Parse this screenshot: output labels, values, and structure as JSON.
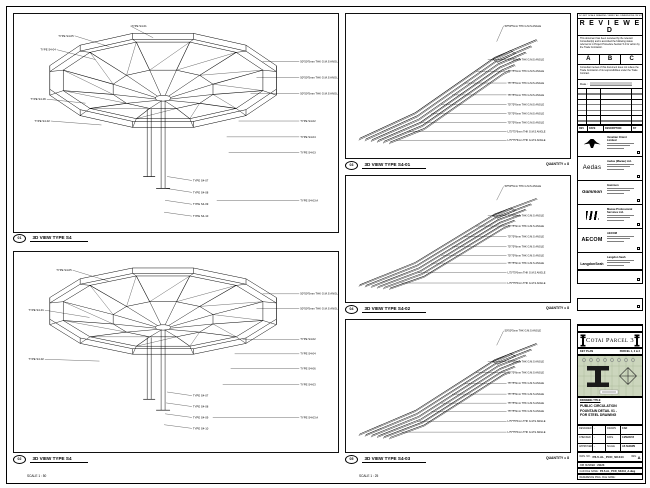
{
  "stamp": {
    "note": "DO NOT SCALE DRAWING. VERIFY ALL DIMENSIONS ON SITE.",
    "title": "R E V I E W E D",
    "body1": "This document has been reviewed by the relevant Consultant(s) and is accorded the following status referred to in Project Procedure Section 5.4 for action by the Trade Contractor.",
    "options": [
      "A",
      "B",
      "C"
    ],
    "body2": "Consultant review of this document does not relieve the Trade Contractor of its responsibilities under the Trade Contract.",
    "date_label": "Date :"
  },
  "revision": {
    "headers": [
      "REV",
      "DATE",
      "DESCRIPTION",
      "BY"
    ]
  },
  "companies": [
    {
      "logo_class": "logo-venetian",
      "logo_name": "venetian-logo-icon",
      "logo_text": "",
      "name": "Venetian Orient Limited"
    },
    {
      "logo_class": "logo-aedas",
      "logo_name": "aedas-logo",
      "logo_text": "Aedas",
      "name": "Aedas (Macau) Ltd."
    },
    {
      "logo_class": "logo-gammon",
      "logo_name": "gammon-logo",
      "logo_text": "Gammon",
      "name": "Gammon"
    },
    {
      "logo_class": "logo-mps",
      "logo_name": "mps-logo-icon",
      "logo_text": "",
      "name": "Macau Professional Services Ltd."
    },
    {
      "logo_class": "logo-aecom",
      "logo_name": "aecom-logo",
      "logo_text": "AECOM",
      "name": "AECOM"
    },
    {
      "logo_class": "logo-langdon",
      "logo_name": "langdon-seah-logo",
      "logo_text": "LangdonSeah",
      "name": "Langdon Seah"
    }
  ],
  "contractor": {
    "name": "Hsin Chong Construction (Macau) Co. Ltd."
  },
  "project": {
    "label": "PROJECT TITLE",
    "title": "Cotai Parcel 3"
  },
  "keyplan": {
    "label": "KEY PLAN",
    "parcel": "PARCEL 1, 2 & 3"
  },
  "titleblock": {
    "label": "DRAWING TITLE",
    "title_lines": [
      "PUBLIC CIRCULATION",
      "FOUNTAIN DETAIL 01 -",
      "FOR STEEL DRAWING"
    ],
    "info": [
      [
        "DESIGNED",
        "-",
        "DRAWN",
        "CAD"
      ],
      [
        "CHECKED",
        "-",
        "DATE",
        "14/MAR/15"
      ],
      [
        "APPROVED",
        "-",
        "SCALE",
        "AS SHOWN"
      ]
    ],
    "dwg_label": "DWG. NO.",
    "dwg_no": "P3-5-AL_PCD_SK444",
    "rev_label": "REV.",
    "rev": "A",
    "job_label": "JOB NUMBER :",
    "job_no": "21123",
    "cad_label": "CAD FILE NAME :",
    "cad_file": "P3-5-AL_PCD_SK444_A.dwg",
    "ref_label": "REFERENCE DWG. FILE NAME :"
  },
  "views": {
    "left_top": {
      "num": "01",
      "title": "3D VIEW TYPE S4",
      "scale": "SCALE 1 : 50",
      "annotations": [
        {
          "t": "TYPE S4-01",
          "lx": 118,
          "ly": 12,
          "tx": 140,
          "ty": 24,
          "anchor": "start"
        },
        {
          "t": "TYPE S4-05",
          "lx": 60,
          "ly": 22,
          "tx": 96,
          "ty": 33,
          "anchor": "end"
        },
        {
          "t": "TYPE S4-04",
          "lx": 42,
          "ly": 36,
          "tx": 82,
          "ty": 46,
          "anchor": "end"
        },
        {
          "t": "TYPE S4-06",
          "lx": 32,
          "ly": 86,
          "tx": 72,
          "ty": 90,
          "anchor": "end"
        },
        {
          "t": "TYPE S4-02",
          "lx": 36,
          "ly": 108,
          "tx": 88,
          "ty": 112,
          "anchor": "end"
        },
        {
          "t": "50*50*5mm THK G.M.S ANGLE",
          "lx": 288,
          "ly": 48,
          "tx": 250,
          "ty": 48,
          "anchor": "start"
        },
        {
          "t": "50*50*5mm THK G.M.S ANGLE",
          "lx": 288,
          "ly": 64,
          "tx": 244,
          "ty": 64,
          "anchor": "start"
        },
        {
          "t": "50*50*5mm THK G.M.S ANGLE",
          "lx": 288,
          "ly": 80,
          "tx": 238,
          "ty": 80,
          "anchor": "start"
        },
        {
          "t": "TYPE S4-02",
          "lx": 288,
          "ly": 108,
          "tx": 226,
          "ty": 108,
          "anchor": "start"
        },
        {
          "t": "TYPE S4-04",
          "lx": 288,
          "ly": 124,
          "tx": 214,
          "ty": 124,
          "anchor": "start"
        },
        {
          "t": "TYPE S4-03",
          "lx": 288,
          "ly": 140,
          "tx": 216,
          "ty": 140,
          "anchor": "start"
        },
        {
          "t": "TYPE S4-03 A",
          "lx": 288,
          "ly": 188,
          "tx": 204,
          "ty": 188,
          "anchor": "start"
        },
        {
          "t": "TYPE S4-07",
          "lx": 180,
          "ly": 168,
          "tx": 154,
          "ty": 164,
          "anchor": "start"
        },
        {
          "t": "TYPE S4-08",
          "lx": 180,
          "ly": 180,
          "tx": 153,
          "ty": 176,
          "anchor": "start"
        },
        {
          "t": "TYPE S4-09",
          "lx": 180,
          "ly": 192,
          "tx": 152,
          "ty": 188,
          "anchor": "start"
        },
        {
          "t": "TYPE S4-10",
          "lx": 180,
          "ly": 204,
          "tx": 151,
          "ty": 200,
          "anchor": "start"
        }
      ]
    },
    "left_bottom": {
      "num": "02",
      "title": "3D VIEW TYPE S4",
      "scale": "SCALE 1 : 50",
      "annotations": [
        {
          "t": "TYPE S4-05",
          "lx": 58,
          "ly": 20,
          "tx": 95,
          "ty": 32,
          "anchor": "end"
        },
        {
          "t": "TYPE S4-01",
          "lx": 30,
          "ly": 64,
          "tx": 76,
          "ty": 72,
          "anchor": "end"
        },
        {
          "t": "TYPE S4-02",
          "lx": 30,
          "ly": 118,
          "tx": 86,
          "ty": 120,
          "anchor": "end"
        },
        {
          "t": "50*50*5mm THK G.M.S ANGLE",
          "lx": 288,
          "ly": 46,
          "tx": 250,
          "ty": 46,
          "anchor": "start"
        },
        {
          "t": "50*50*5mm THK G.M.S ANGLE",
          "lx": 288,
          "ly": 62,
          "tx": 244,
          "ty": 62,
          "anchor": "start"
        },
        {
          "t": "TYPE S4-02",
          "lx": 288,
          "ly": 96,
          "tx": 230,
          "ty": 96,
          "anchor": "start"
        },
        {
          "t": "TYPE S4-04",
          "lx": 288,
          "ly": 112,
          "tx": 222,
          "ty": 112,
          "anchor": "start"
        },
        {
          "t": "TYPE S4-06",
          "lx": 288,
          "ly": 128,
          "tx": 218,
          "ty": 128,
          "anchor": "start"
        },
        {
          "t": "TYPE S4-03",
          "lx": 288,
          "ly": 146,
          "tx": 210,
          "ty": 146,
          "anchor": "start"
        },
        {
          "t": "TYPE S4-03 A",
          "lx": 288,
          "ly": 182,
          "tx": 200,
          "ty": 182,
          "anchor": "start"
        },
        {
          "t": "TYPE S4-07",
          "lx": 180,
          "ly": 158,
          "tx": 154,
          "ty": 154,
          "anchor": "start"
        },
        {
          "t": "TYPE S4-08",
          "lx": 180,
          "ly": 170,
          "tx": 153,
          "ty": 166,
          "anchor": "start"
        },
        {
          "t": "TYPE S4-09",
          "lx": 180,
          "ly": 182,
          "tx": 152,
          "ty": 178,
          "anchor": "start"
        },
        {
          "t": "TYPE S4-10",
          "lx": 180,
          "ly": 194,
          "tx": 151,
          "ty": 190,
          "anchor": "start"
        }
      ]
    },
    "mid_top": {
      "num": "03",
      "title": "3D VIEW TYPE S4-01",
      "scale": "SCALE 1 : 25",
      "quantity": "QUANTITY = 8",
      "annotations": [
        {
          "t": "50*50*5mm THK G.M.S ANGLE",
          "lx": 160,
          "ly": 12,
          "tx": 152,
          "ty": 28,
          "anchor": "start"
        },
        {
          "t": "75*75*6mm THK G.M.S ANGLE",
          "lx": 163,
          "ly": 46,
          "tx": 143,
          "ty": 46,
          "anchor": "start"
        },
        {
          "t": "75*75*6mm THK G.M.S ANGLE",
          "lx": 163,
          "ly": 58,
          "tx": 131,
          "ty": 58,
          "anchor": "start"
        },
        {
          "t": "75*75*6mm THK G.M.S ANGLE",
          "lx": 163,
          "ly": 70,
          "tx": 119,
          "ty": 70,
          "anchor": "start"
        },
        {
          "t": "75*75*6mm THK G.M.S ANGLE",
          "lx": 163,
          "ly": 82,
          "tx": 107,
          "ty": 82,
          "anchor": "start"
        },
        {
          "t": "75*75*6mm THK G.M.S ANGLE",
          "lx": 163,
          "ly": 92,
          "tx": 96,
          "ty": 92,
          "anchor": "start"
        },
        {
          "t": "75*75*6mm THK G.M.S ANGLE",
          "lx": 163,
          "ly": 101,
          "tx": 86,
          "ty": 101,
          "anchor": "start"
        },
        {
          "t": "75*75*6mm THK G.M.S ANGLE",
          "lx": 163,
          "ly": 110,
          "tx": 75,
          "ty": 110,
          "anchor": "start"
        },
        {
          "t": "L75*75*6mm THK G.M.S ANGLE",
          "lx": 163,
          "ly": 119,
          "tx": 63,
          "ty": 119,
          "anchor": "start"
        },
        {
          "t": "L75*75*6mm THK G.M.S ANGLE",
          "lx": 163,
          "ly": 128,
          "tx": 51,
          "ty": 128,
          "anchor": "start"
        }
      ]
    },
    "mid_mid": {
      "num": "04",
      "title": "3D VIEW TYPE S4-02",
      "scale": "SCALE 1 : 25",
      "quantity": "QUANTITY = 8",
      "annotations": [
        {
          "t": "50*50*5mm THK G.M.S ANGLE",
          "lx": 160,
          "ly": 12,
          "tx": 152,
          "ty": 28,
          "anchor": "start"
        },
        {
          "t": "75*75*6mm THK G.M.S ANGLE",
          "lx": 163,
          "ly": 46,
          "tx": 143,
          "ty": 46,
          "anchor": "start"
        },
        {
          "t": "75*75*6mm THK G.M.S ANGLE",
          "lx": 163,
          "ly": 58,
          "tx": 131,
          "ty": 58,
          "anchor": "start"
        },
        {
          "t": "75*75*6mm THK G.M.S ANGLE",
          "lx": 163,
          "ly": 70,
          "tx": 119,
          "ty": 70,
          "anchor": "start"
        },
        {
          "t": "75*75*6mm THK G.M.S ANGLE",
          "lx": 163,
          "ly": 82,
          "tx": 107,
          "ty": 82,
          "anchor": "start"
        },
        {
          "t": "75*75*6mm THK G.M.S ANGLE",
          "lx": 163,
          "ly": 92,
          "tx": 96,
          "ty": 92,
          "anchor": "start"
        },
        {
          "t": "75*75*6mm THK G.M.S ANGLE",
          "lx": 163,
          "ly": 101,
          "tx": 86,
          "ty": 101,
          "anchor": "start"
        },
        {
          "t": "L75*75*6mm THK G.M.S ANGLE",
          "lx": 163,
          "ly": 112,
          "tx": 72,
          "ty": 112,
          "anchor": "start"
        },
        {
          "t": "L75*75*6mm THK G.M.S ANGLE",
          "lx": 163,
          "ly": 124,
          "tx": 56,
          "ty": 124,
          "anchor": "start"
        }
      ]
    },
    "mid_bottom": {
      "num": "05",
      "title": "3D VIEW TYPE S4-03",
      "scale": "SCALE 1 : 25",
      "quantity": "QUANTITY = 8",
      "annotations": [
        {
          "t": "50*50*5mm THK G.M.S ANGLE",
          "lx": 160,
          "ly": 12,
          "tx": 152,
          "ty": 28,
          "anchor": "start"
        },
        {
          "t": "75*75*6mm THK G.M.S ANGLE",
          "lx": 163,
          "ly": 46,
          "tx": 143,
          "ty": 46,
          "anchor": "start"
        },
        {
          "t": "75*75*6mm THK G.M.S ANGLE",
          "lx": 163,
          "ly": 58,
          "tx": 131,
          "ty": 58,
          "anchor": "start"
        },
        {
          "t": "75*75*6mm THK G.M.S ANGLE",
          "lx": 163,
          "ly": 70,
          "tx": 119,
          "ty": 70,
          "anchor": "start"
        },
        {
          "t": "75*75*6mm THK G.M.S ANGLE",
          "lx": 163,
          "ly": 82,
          "tx": 107,
          "ty": 82,
          "anchor": "start"
        },
        {
          "t": "75*75*6mm THK G.M.S ANGLE",
          "lx": 163,
          "ly": 92,
          "tx": 96,
          "ty": 92,
          "anchor": "start"
        },
        {
          "t": "75*75*6mm THK G.M.S ANGLE",
          "lx": 163,
          "ly": 101,
          "tx": 86,
          "ty": 101,
          "anchor": "start"
        },
        {
          "t": "L75*75*6mm THK G.M.S ANGLE",
          "lx": 163,
          "ly": 112,
          "tx": 72,
          "ty": 112,
          "anchor": "start"
        },
        {
          "t": "L75*75*6mm THK G.M.S ANGLE",
          "lx": 163,
          "ly": 124,
          "tx": 56,
          "ty": 124,
          "anchor": "start"
        }
      ]
    }
  }
}
